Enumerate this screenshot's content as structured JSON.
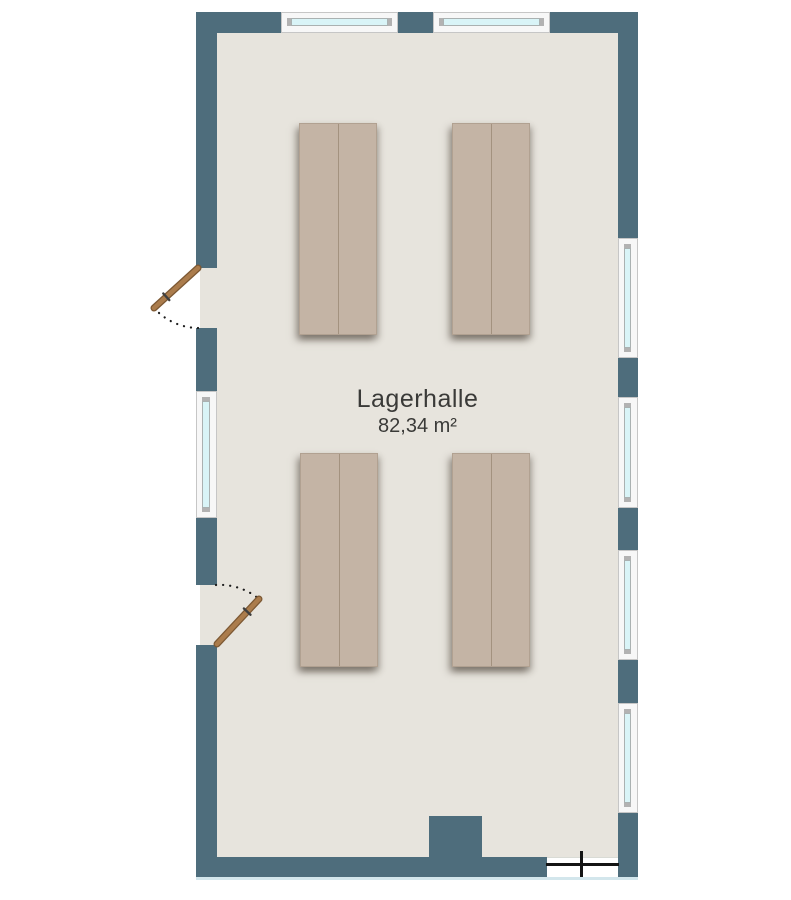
{
  "room": {
    "name": "Lagerhalle",
    "area": "82,34 m²"
  },
  "colors": {
    "wall": "#4e6d7c",
    "floor": "#e7e4dd",
    "exterior": "#ffffff",
    "window_frame": "#f7f7f7",
    "window_glass": "#d9f4f7",
    "window_cap": "#b2b2b2",
    "door_leaf": "#ab7c4c",
    "door_outline": "#7c5833",
    "swing_arc": "#1c1c1c",
    "shelf": "#c4b4a5",
    "opening_marker": "#141414",
    "label_text": "#3a3a38"
  },
  "elements": {
    "windows_top": 2,
    "windows_left": 1,
    "windows_right": 4,
    "doors_left": 2,
    "storage_racks": 4,
    "bottom_openings": 1,
    "pillars": 1
  }
}
